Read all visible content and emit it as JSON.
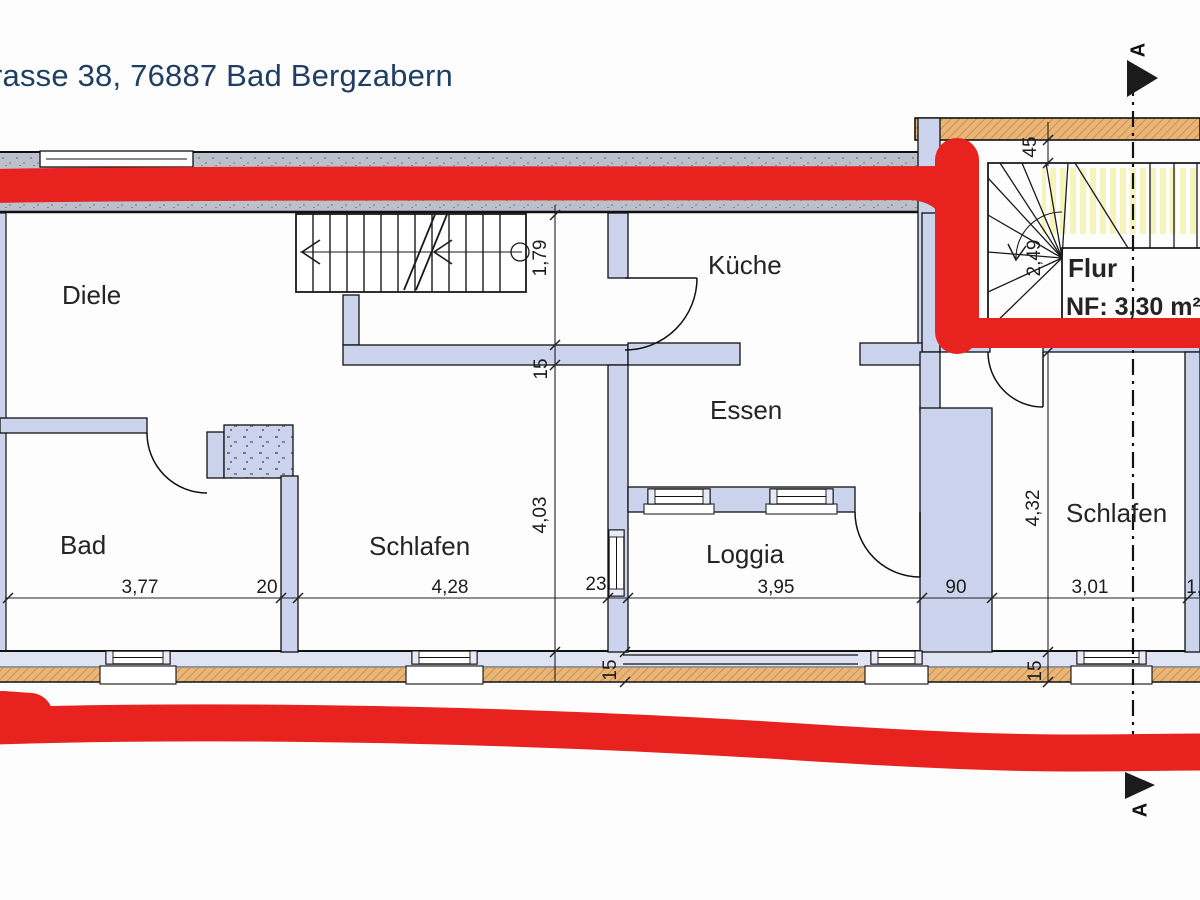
{
  "title": "rasse 38, 76887 Bad Bergzabern",
  "rooms": {
    "diele": "Diele",
    "kueche": "Küche",
    "essen": "Essen",
    "bad": "Bad",
    "schlafen_left": "Schlafen",
    "loggia": "Loggia",
    "flur": "Flur",
    "flur_area": "NF: 3,30 m²",
    "schlafen_right": "Schlafen"
  },
  "dimensions": {
    "horizontal": {
      "bad_width": "3,77",
      "wall_20": "20",
      "schlafen_left_width": "4,28",
      "wall_23": "23",
      "loggia_width": "3,95",
      "wall_90": "90",
      "schlafen_right_width": "3,01",
      "cut_off_right": "1,"
    },
    "vertical_left": {
      "stair_opening": "1,79",
      "wall_15": "15",
      "room_depth": "4,03"
    },
    "vertical_right": {
      "wall_45": "45",
      "stair_run": "2,49",
      "room_depth": "4,32"
    },
    "wall_thickness": {
      "bottom_left": "15",
      "bottom_right": "15"
    }
  },
  "section_marker": {
    "top": "A",
    "bottom": "A"
  },
  "colors": {
    "marker_red": "#e8231f",
    "wall_fill_lavender": "#ccd3ec",
    "exterior_wall_orange": "#eab678",
    "top_wall_gray": "#b9bdc6",
    "stair_highlight_yellow": "#f6f4bb",
    "title_blue": "#1e3f63"
  }
}
